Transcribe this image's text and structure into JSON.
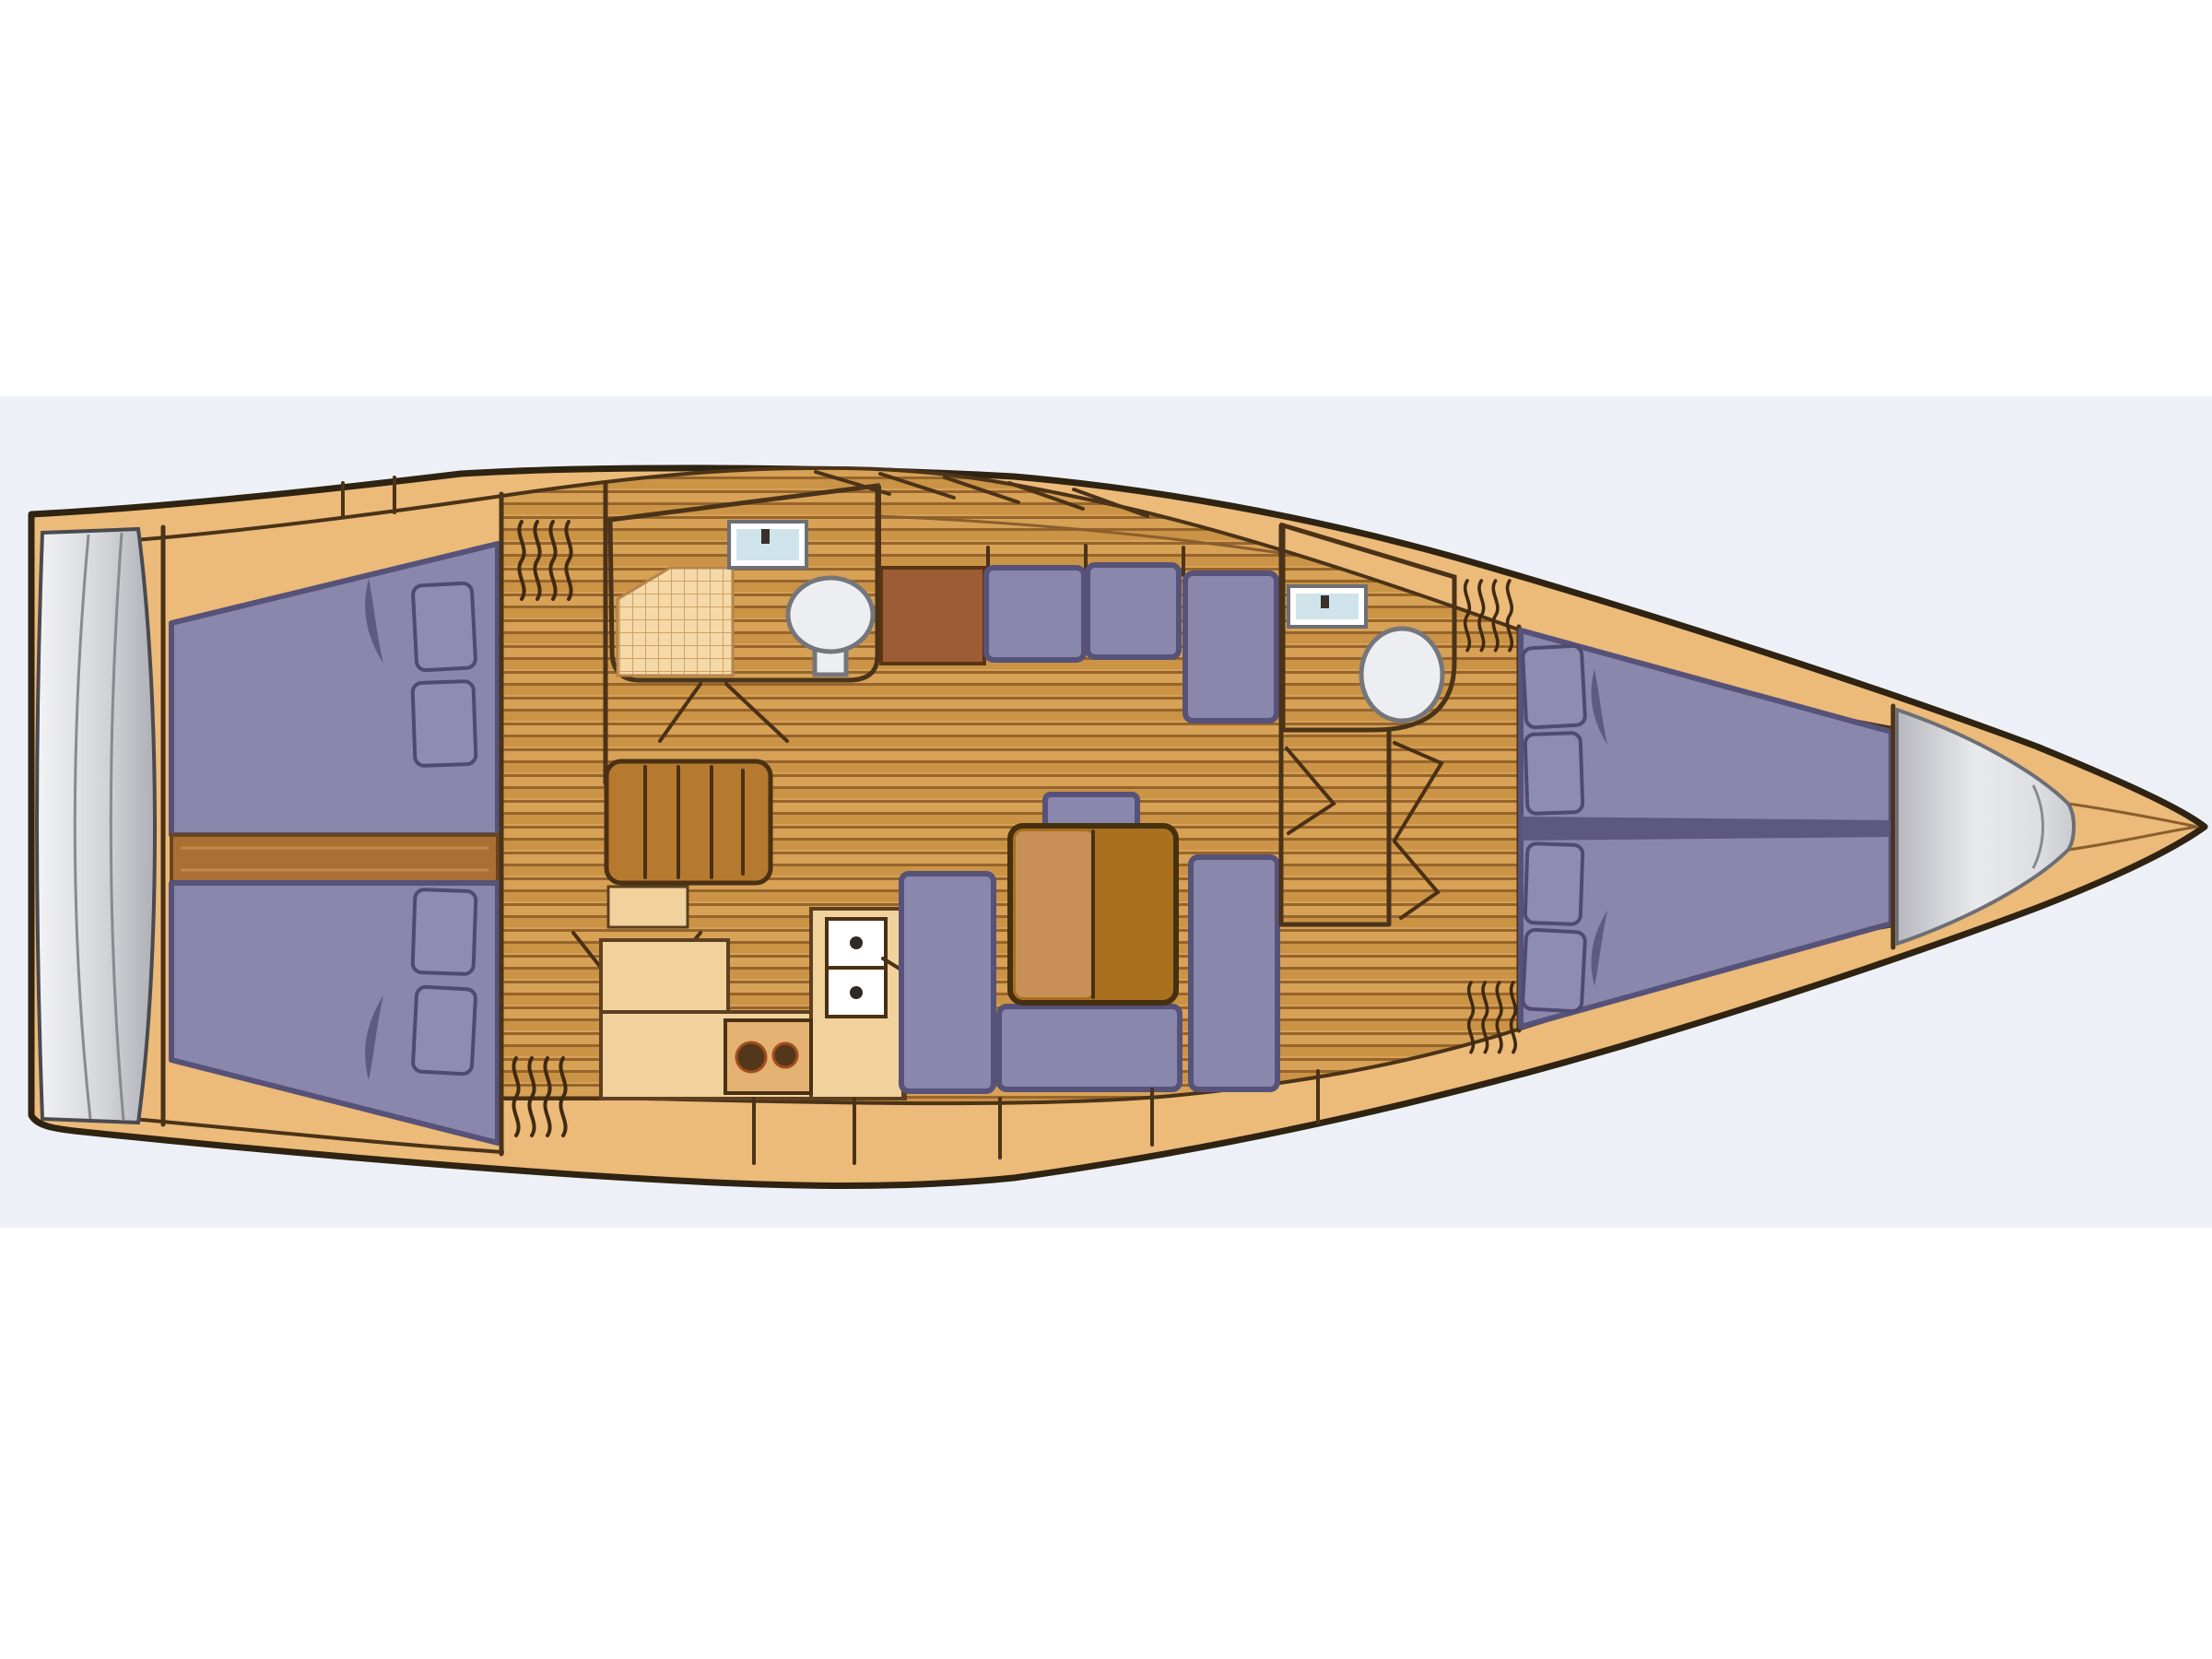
{
  "figure": {
    "kind": "sailboat-interior-floor-plan-top-view",
    "orientation": "bow-right-stern-left",
    "text_visible": "none"
  },
  "colors": {
    "page_white": "#ffffff",
    "backdrop_blue_gray": "#edf1f7",
    "hull_tan": "#ecba79",
    "hull_outline": "#2f2312",
    "room_cream": "#f7dcae",
    "counter_cream": "#f2d29c",
    "wood_light": "#d7a156",
    "wood_dark": "#cb9345",
    "wood_seam": "#96642c",
    "berth_purple": "#8a87ac",
    "berth_outline": "#565279",
    "pillow_purple": "#8f8cb1",
    "divider_purple": "#5c5880",
    "corridor_brown": "#a96f33",
    "sideboard_brown": "#9c5c35",
    "table_brown": "#a9701f",
    "table_leaf": "#c89057",
    "steps_brown": "#b5792f",
    "sink_blue": "#cfe4ea",
    "fixture_white": "#ffffff",
    "toilet_gray": "#eceef1",
    "burner_dark": "#53371a",
    "transom_light": "#f0f1f4",
    "transom_dark": "#aeb0b6"
  },
  "labels": {
    "hull": "hull",
    "transom": "swim-platform-transom",
    "aft_cabin_port": "aft-cabin-port-double-berth",
    "aft_cabin_starboard": "aft-cabin-starboard-double-berth",
    "engine_corridor": "engine-compartment-corridor",
    "aft_head": "aft-head-with-shower",
    "companionway": "companionway-steps",
    "galley": "galley",
    "salon_bench": "salon-l-bench-port",
    "dinette": "dinette-u-sofa-with-table",
    "forward_head": "forward-head",
    "forward_cabin": "forward-v-berth-cabin",
    "bow_locker": "bow-sail-locker"
  },
  "inventory": {
    "double_berths": 3,
    "pillows_total": 8,
    "heads_bathrooms": 2,
    "toilets": 2,
    "wash_sinks": 2,
    "galley_sink_basins": 2,
    "stove_burners": 2,
    "companionway_treads": 4,
    "salon_bench_cushions": 3,
    "dinette_seat_sections": 4,
    "vent_hatches": 4,
    "shower_grids": 1
  }
}
